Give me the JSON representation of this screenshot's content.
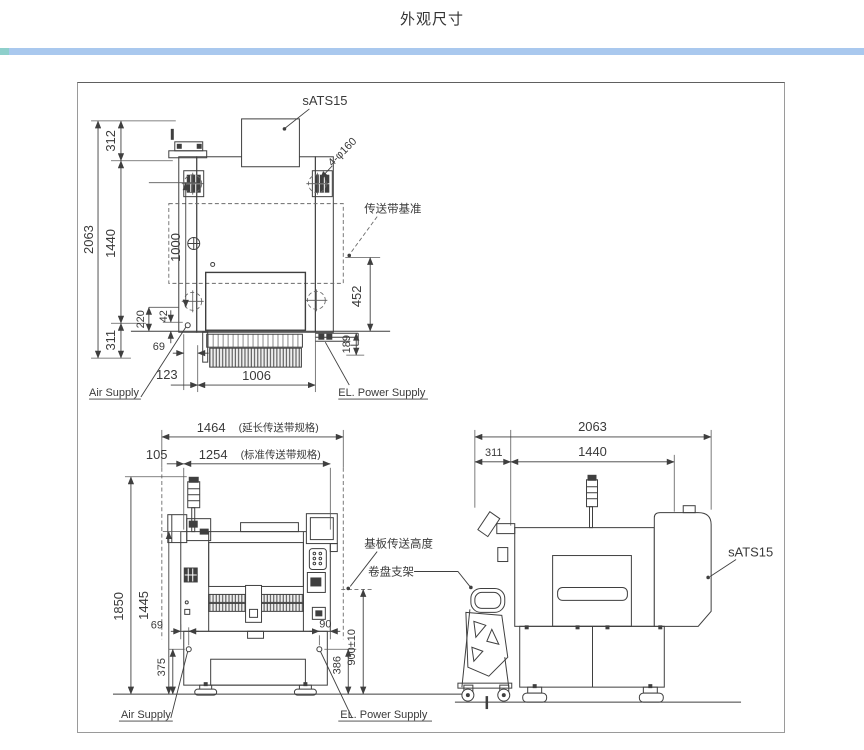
{
  "page": {
    "title": "外观尺寸"
  },
  "colors": {
    "divider_blue": "#a9c8ee",
    "divider_teal": "#8ecfcb",
    "drawing_line": "#3f3f3f",
    "frame_border": "#9a9a9a",
    "background": "#ffffff"
  },
  "top_view": {
    "unit_label": "sATS15",
    "holes_label": "4-φ160",
    "conveyor_ref_label": "传送带基准",
    "air_supply_label": "Air Supply",
    "power_supply_label": "EL. Power Supply",
    "dims": {
      "total_depth": "2063",
      "rear_section": "312",
      "frame_depth": "1440",
      "rail_span": "1000",
      "d220": "220",
      "d42": "42",
      "front_section": "311",
      "d69": "69",
      "d123": "123",
      "front_width": "1006",
      "conveyor_offset": "452",
      "bracket_drop": "189"
    }
  },
  "front_view": {
    "width_extended": "1464",
    "width_extended_note": "(延长传送带规格)",
    "width_standard": "1254",
    "width_standard_note": "(标准传送带规格)",
    "side_margin": "105",
    "height_total": "1850",
    "height_frame": "1445",
    "air_offset": "69",
    "air_height": "375",
    "power_offset": "90",
    "power_height": "386",
    "transfer_height": "900±10",
    "pcb_transfer_label": "基板传送高度",
    "reel_rack_label": "卷盘支架",
    "air_supply_label": "Air Supply",
    "power_supply_label": "EL. Power Supply"
  },
  "side_view": {
    "depth_total": "2063",
    "rear_margin": "311",
    "frame_depth": "1440",
    "unit_label": "sATS15"
  }
}
